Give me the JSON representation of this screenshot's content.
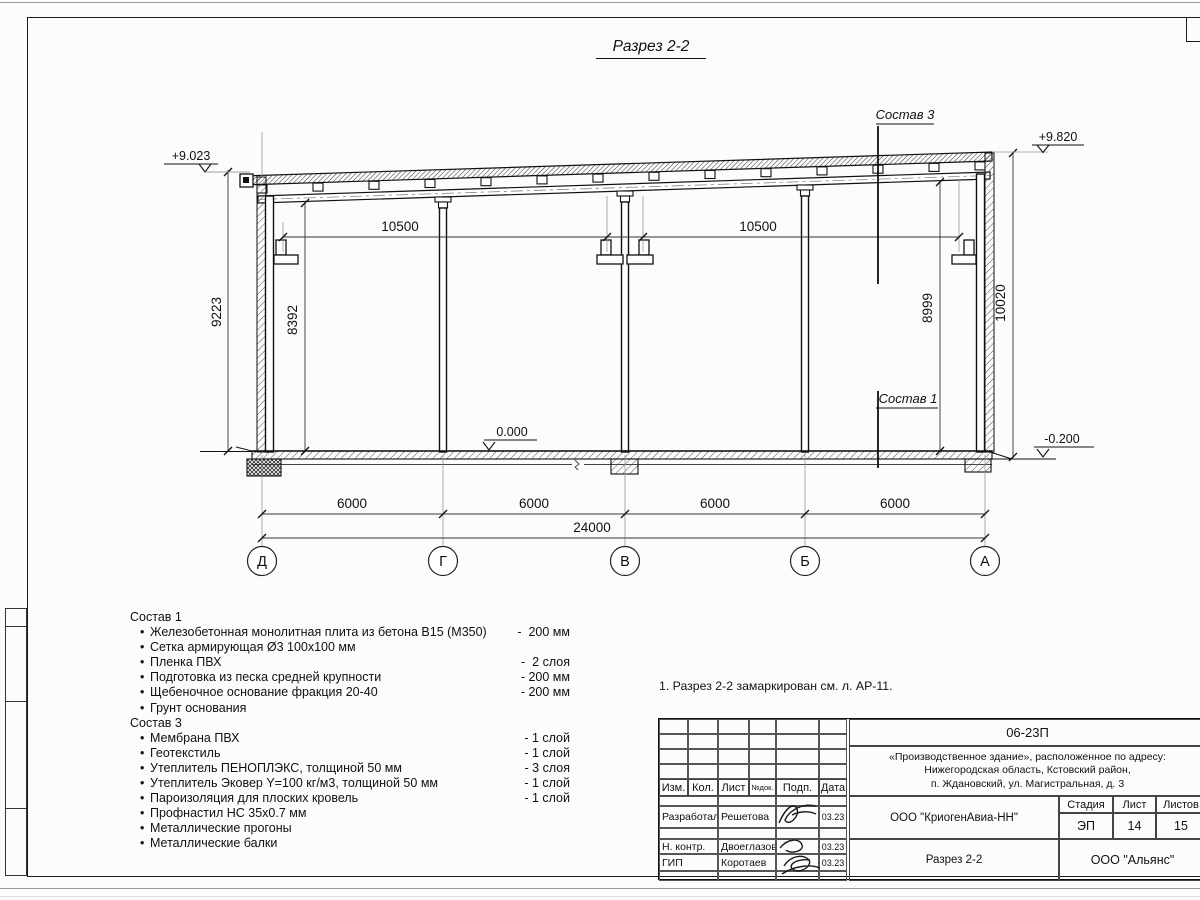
{
  "sheet": {
    "title": "Разрез 2-2",
    "note": "1. Разрез 2-2 замаркирован см. л. АР-11."
  },
  "drawing": {
    "elevations": {
      "top_left": "+9.023",
      "top_right": "+9.820",
      "floor": "0.000",
      "ground_right": "-0.200"
    },
    "span_dims": {
      "left": "10500",
      "right": "10500"
    },
    "vertical_dims": {
      "outer_left": "9223",
      "inner_left": "8392",
      "inner_right": "8999",
      "outer_right": "10020"
    },
    "bay_dims": [
      "6000",
      "6000",
      "6000",
      "6000"
    ],
    "total_dim": "24000",
    "axes": [
      "Д",
      "Г",
      "В",
      "Б",
      "А"
    ],
    "leaders": {
      "sostav3": "Состав 3",
      "sostav1": "Состав 1"
    }
  },
  "compositions": {
    "bullet": "•",
    "sostav1": {
      "heading": "Состав 1",
      "items": [
        {
          "name": "Железобетонная монолитная плита из бетона В15 (М350)",
          "value": "-  200 мм"
        },
        {
          "name": "Сетка армирующая Ø3 100х100 мм",
          "value": ""
        },
        {
          "name": "Пленка ПВХ",
          "value": "-  2 слоя"
        },
        {
          "name": "Подготовка из песка средней крупности",
          "value": "- 200 мм"
        },
        {
          "name": "Щебеночное основание фракция 20-40",
          "value": "- 200 мм"
        },
        {
          "name": "Грунт основания",
          "value": ""
        }
      ]
    },
    "sostav3": {
      "heading": "Состав 3",
      "items": [
        {
          "name": "Мембрана ПВХ",
          "value": "- 1 слой"
        },
        {
          "name": "Геотекстиль",
          "value": "- 1 слой"
        },
        {
          "name": "Утеплитель ПЕНОПЛЭКС, толщиной 50 мм",
          "value": "- 3 слоя"
        },
        {
          "name": "Утеплитель Эковер Y=100 кг/м3, толщиной 50 мм",
          "value": "- 1 слой"
        },
        {
          "name": "Пароизоляция для плоских кровель",
          "value": "- 1 слой"
        },
        {
          "name": "Профнастил НС 35х0.7 мм",
          "value": ""
        },
        {
          "name": "Металлические прогоны",
          "value": ""
        },
        {
          "name": "Металлические балки",
          "value": ""
        }
      ]
    }
  },
  "titleblock": {
    "doc_number": "06-23П",
    "object_line1": "«Производственное здание», расположенное по адресу:",
    "object_line2": "Нижегородская область, Кстовский район,",
    "object_line3": "п. Ждановский, ул. Магистральная, д. 3",
    "header": {
      "izm": "Изм.",
      "kol": "Кол.",
      "list": "Лист",
      "ndok": "№док.",
      "podp": "Подп.",
      "data": "Дата"
    },
    "rows": [
      {
        "role": "Разработал",
        "name": "Решетова",
        "date": "03.23"
      },
      {
        "role": "Н. контр.",
        "name": "Двоеглазов",
        "date": "03.23"
      },
      {
        "role": "ГИП",
        "name": "Коротаев",
        "date": "03.23"
      }
    ],
    "org": "ООО \"КриогенАвиа-НН\"",
    "drawing_name": "Разрез 2-2",
    "stage_header": {
      "stage": "Стадия",
      "sheet": "Лист",
      "sheets": "Листов"
    },
    "stage": "ЭП",
    "sheet_no": "14",
    "sheets_total": "15",
    "company": "ООО \"Альянс\""
  }
}
